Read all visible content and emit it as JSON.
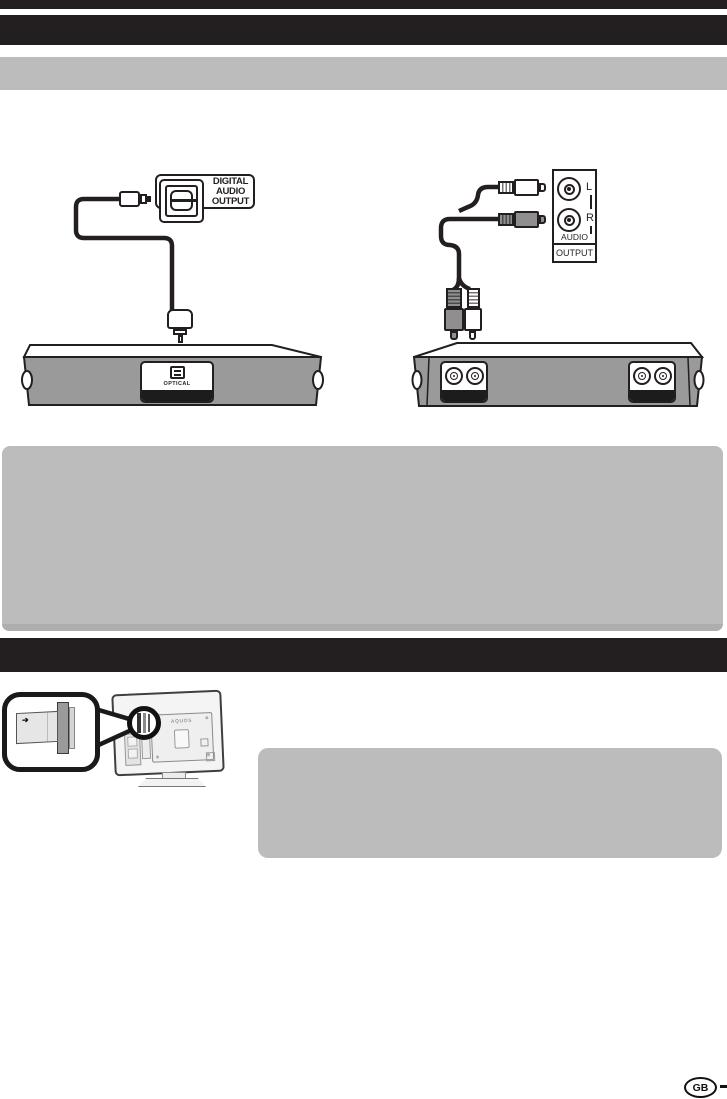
{
  "colors": {
    "bar_black": "#231f20",
    "note_box_gray": "#bcbcbc",
    "device_body_gray": "#9a9a9a",
    "panel_strip_black": "#1c1c1c"
  },
  "left_diagram": {
    "port_label_lines": [
      "DIGITAL",
      "AUDIO",
      "OUTPUT"
    ],
    "device_port_label": "OPTICAL"
  },
  "right_diagram": {
    "jack_labels": {
      "left": "L",
      "right": "R"
    },
    "panel_label": "AUDIO",
    "panel_section_label": "OUTPUT"
  },
  "ci_diagram": {
    "tv_brand_label": "AQUOS",
    "card_arrow_icon": "➔"
  },
  "footer": {
    "region_badge": "GB"
  }
}
